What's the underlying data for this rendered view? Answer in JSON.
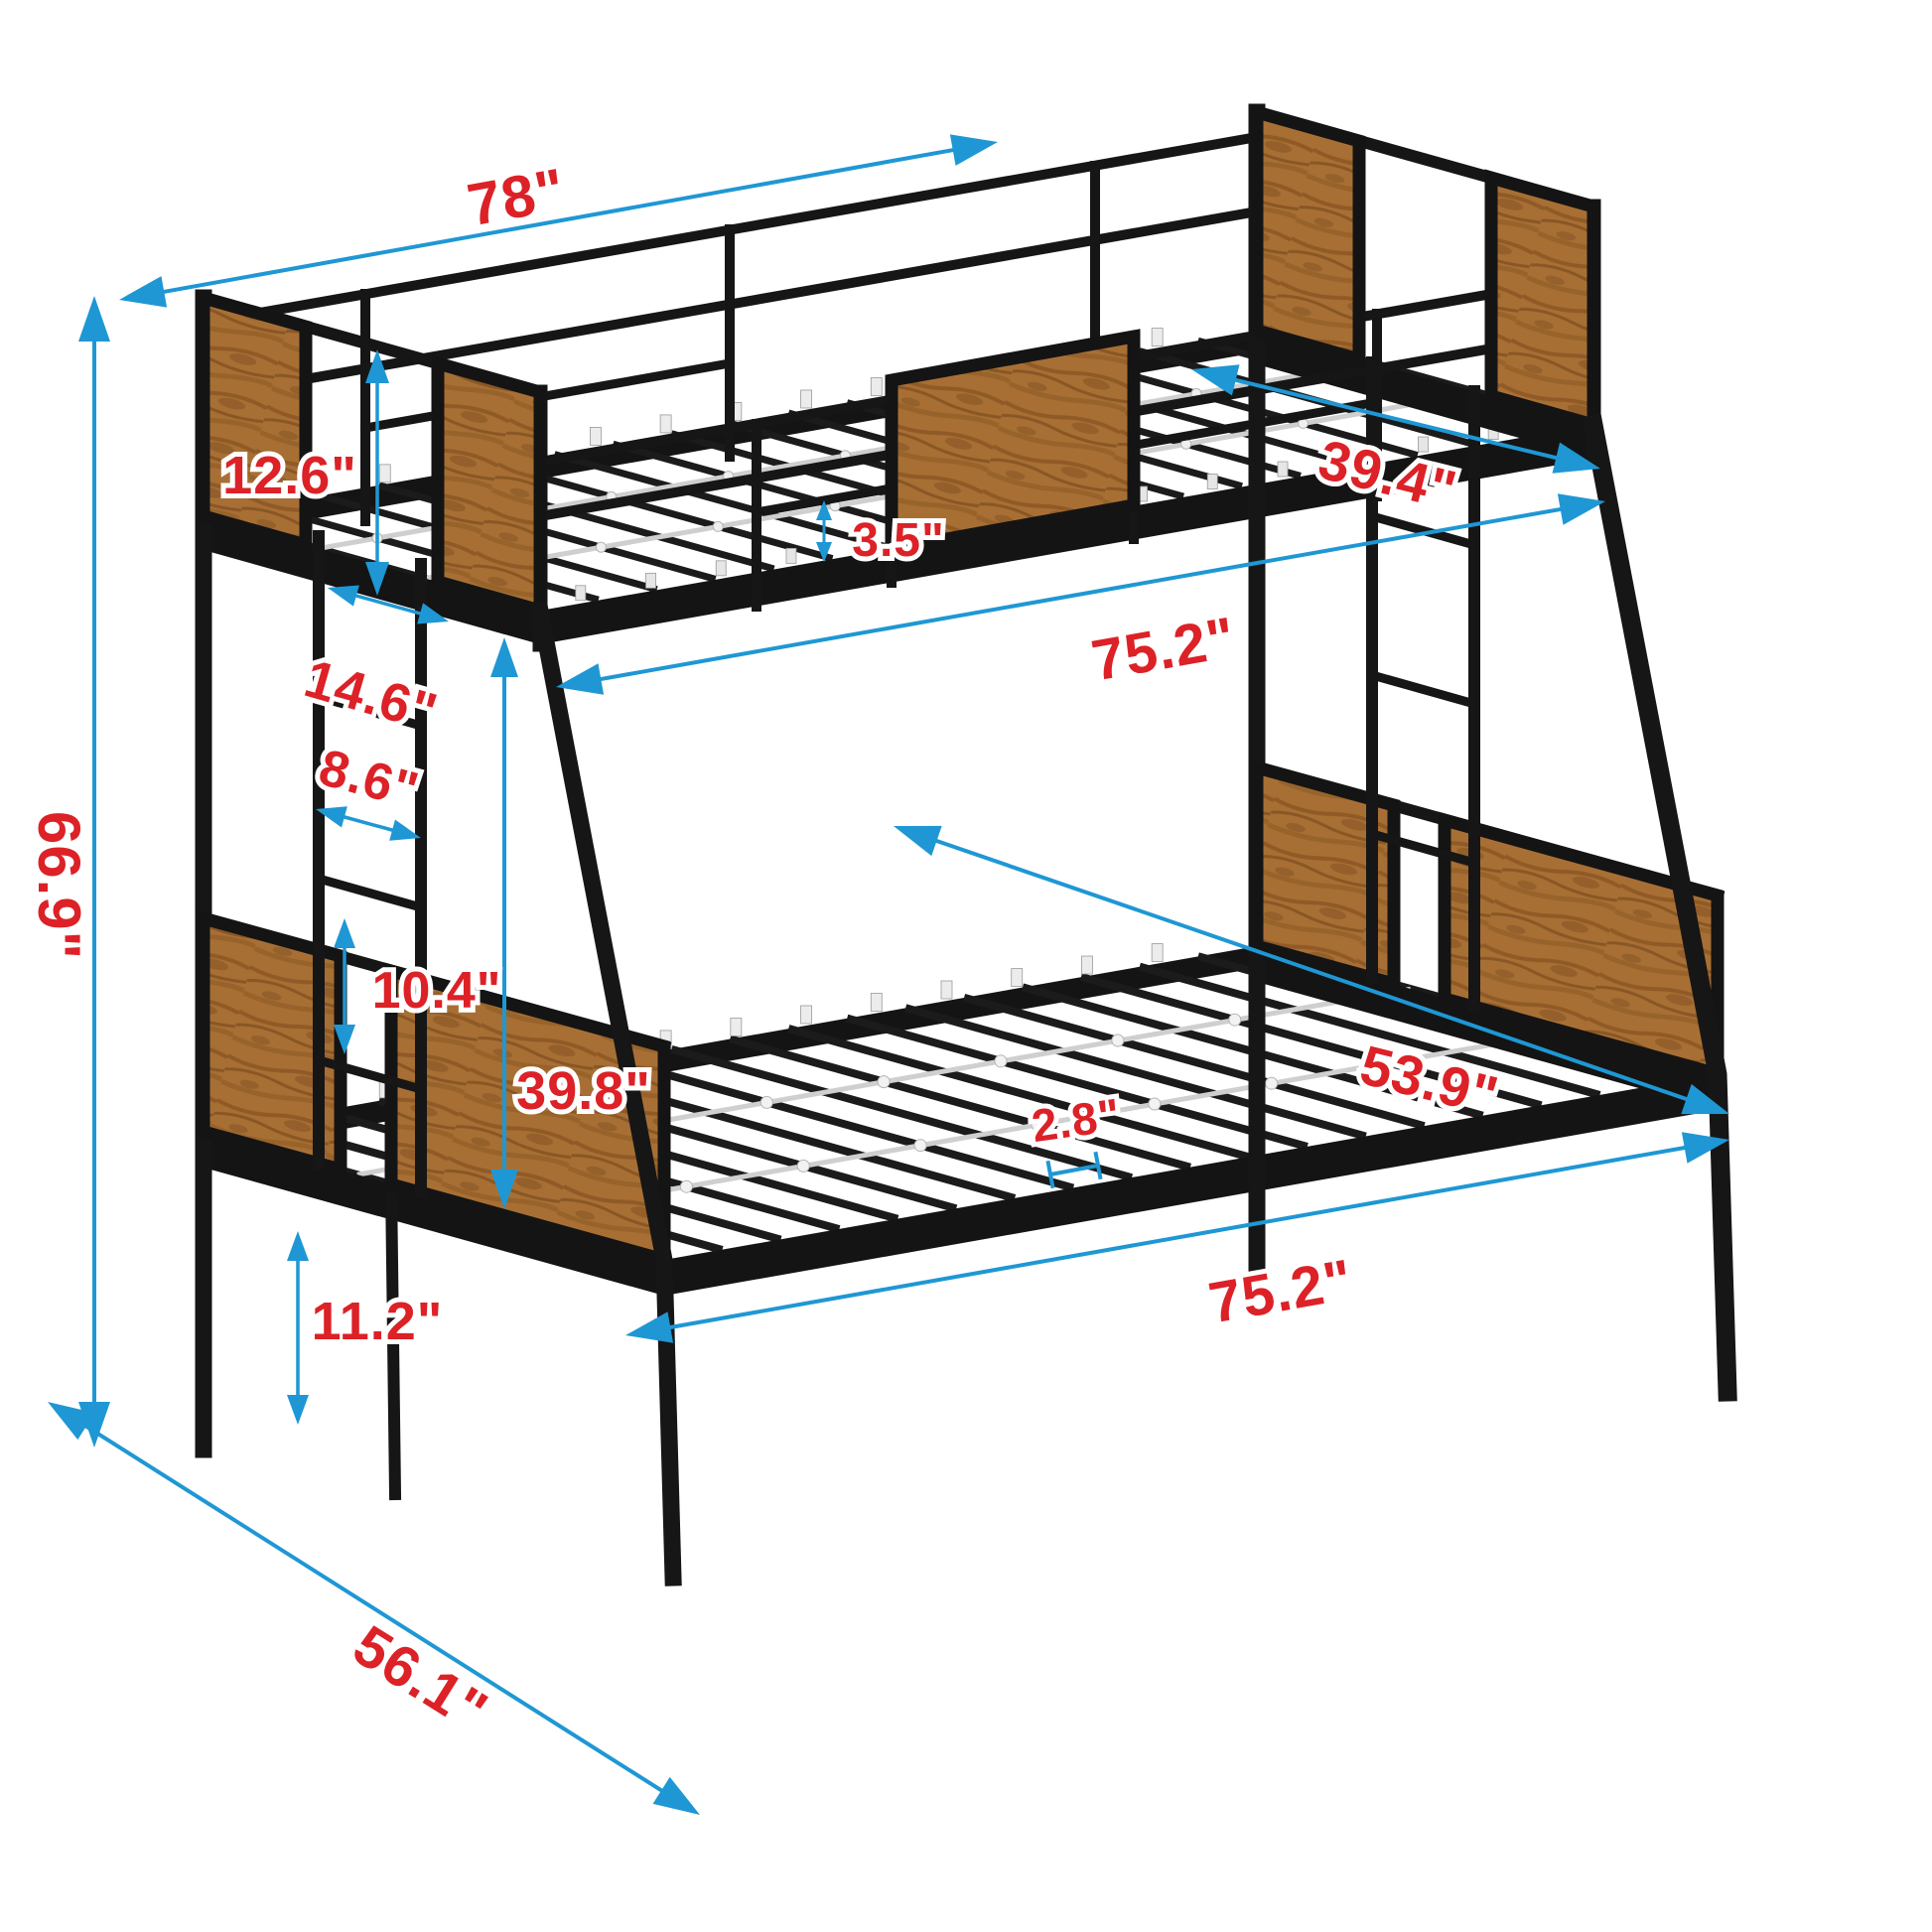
{
  "diagram": {
    "subject": "twin-over-full metal bunk bed dimension diagram",
    "unit_note": "inches",
    "colors": {
      "dimension_line": "#1f97d4",
      "dimension_label": "#dc2127",
      "frame": "#161616",
      "wood": "#a86f34",
      "slat_support": "#cfcfcf",
      "background": "#ffffff"
    },
    "dimensions": {
      "overall_length": "78\"",
      "top_bed_width": "39.4\"",
      "panel_height": "12.6\"",
      "front_overhang": "14.6\"",
      "ladder_width": "8.6\"",
      "rung_spacing": "10.4\"",
      "overall_height": "66.9\"",
      "guardrail_gap": "3.5\"",
      "top_sleeping_length": "75.2\"",
      "bunk_clearance": "39.8\"",
      "bottom_bed_width": "53.9\"",
      "slat_gap": "2.8\"",
      "bottom_sleeping_length": "75.2\"",
      "under_bed_height": "11.2\"",
      "overall_depth": "56.1\""
    }
  }
}
